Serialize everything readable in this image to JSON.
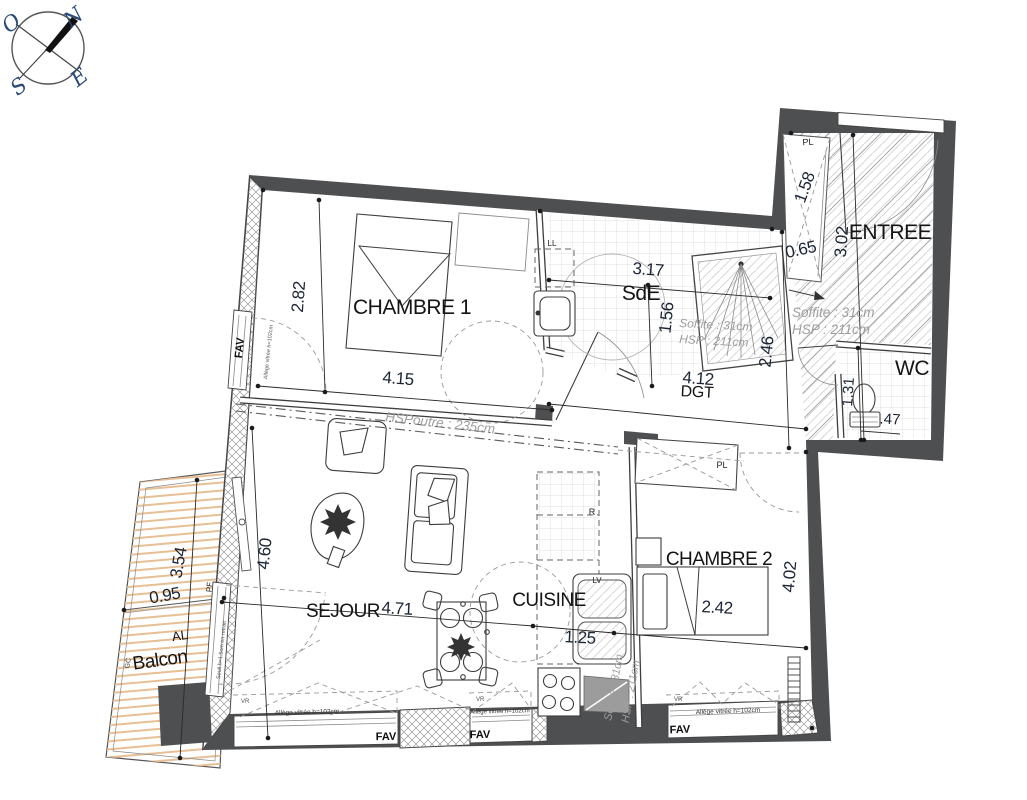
{
  "compass": {
    "n": "N",
    "e": "E",
    "s": "S",
    "o": "O"
  },
  "rooms": {
    "chambre1": {
      "name": "CHAMBRE 1",
      "dim_w": "4.15",
      "dim_h": "2.82"
    },
    "sde": {
      "name": "SdE",
      "dim_w": "3.17",
      "dim_h": "1.56",
      "soffite": "Soffite : 31cm",
      "hsp": "HSP : 211cm"
    },
    "dgt": {
      "name": "DGT",
      "dim_w": "4.12",
      "dim_h": "2.46"
    },
    "entree": {
      "name": "ENTREE",
      "dim_h": "3.02",
      "closet": "PL",
      "closet_d": "1.58",
      "closet_w": "0.65",
      "soffite": "Soffite : 31cm",
      "hsp": "HSP : 211cm"
    },
    "wc": {
      "name": "WC",
      "dim_h": "1.31",
      "dim_w": ".47"
    },
    "sejour": {
      "name": "SEJOUR",
      "dim_w": "4.71",
      "dim_h": "4.60"
    },
    "cuisine": {
      "name": "CUISINE",
      "dim_w": "1.25",
      "fridge": "R",
      "dishwasher": "LV",
      "soffite": "Soffite : 31cm",
      "hsp": "HSP : 211cm"
    },
    "chambre2": {
      "name": "CHAMBRE 2",
      "dim_w": "2.42",
      "dim_h": "4.02",
      "closet": "PL"
    },
    "balcon": {
      "name": "Balcon",
      "dim_l": "3.54",
      "dim_w": "0.95",
      "al": "AL",
      "gc": "GC"
    }
  },
  "labels": {
    "fav": "FAV",
    "pf": "PF",
    "vr": "VR",
    "ll": "LL",
    "beam": "HSPoutre : 235cm",
    "sill": "Allège vitrée h=102cm",
    "seuil": "Seuil h=1.5cm en retrait"
  },
  "colors": {
    "wall": "#4e4f51",
    "wood_deck": "#e7bf95",
    "annotation_gray": "#9e9e9e",
    "dimension_text": "#1c2535",
    "compass_blue": "#2b4a75"
  }
}
